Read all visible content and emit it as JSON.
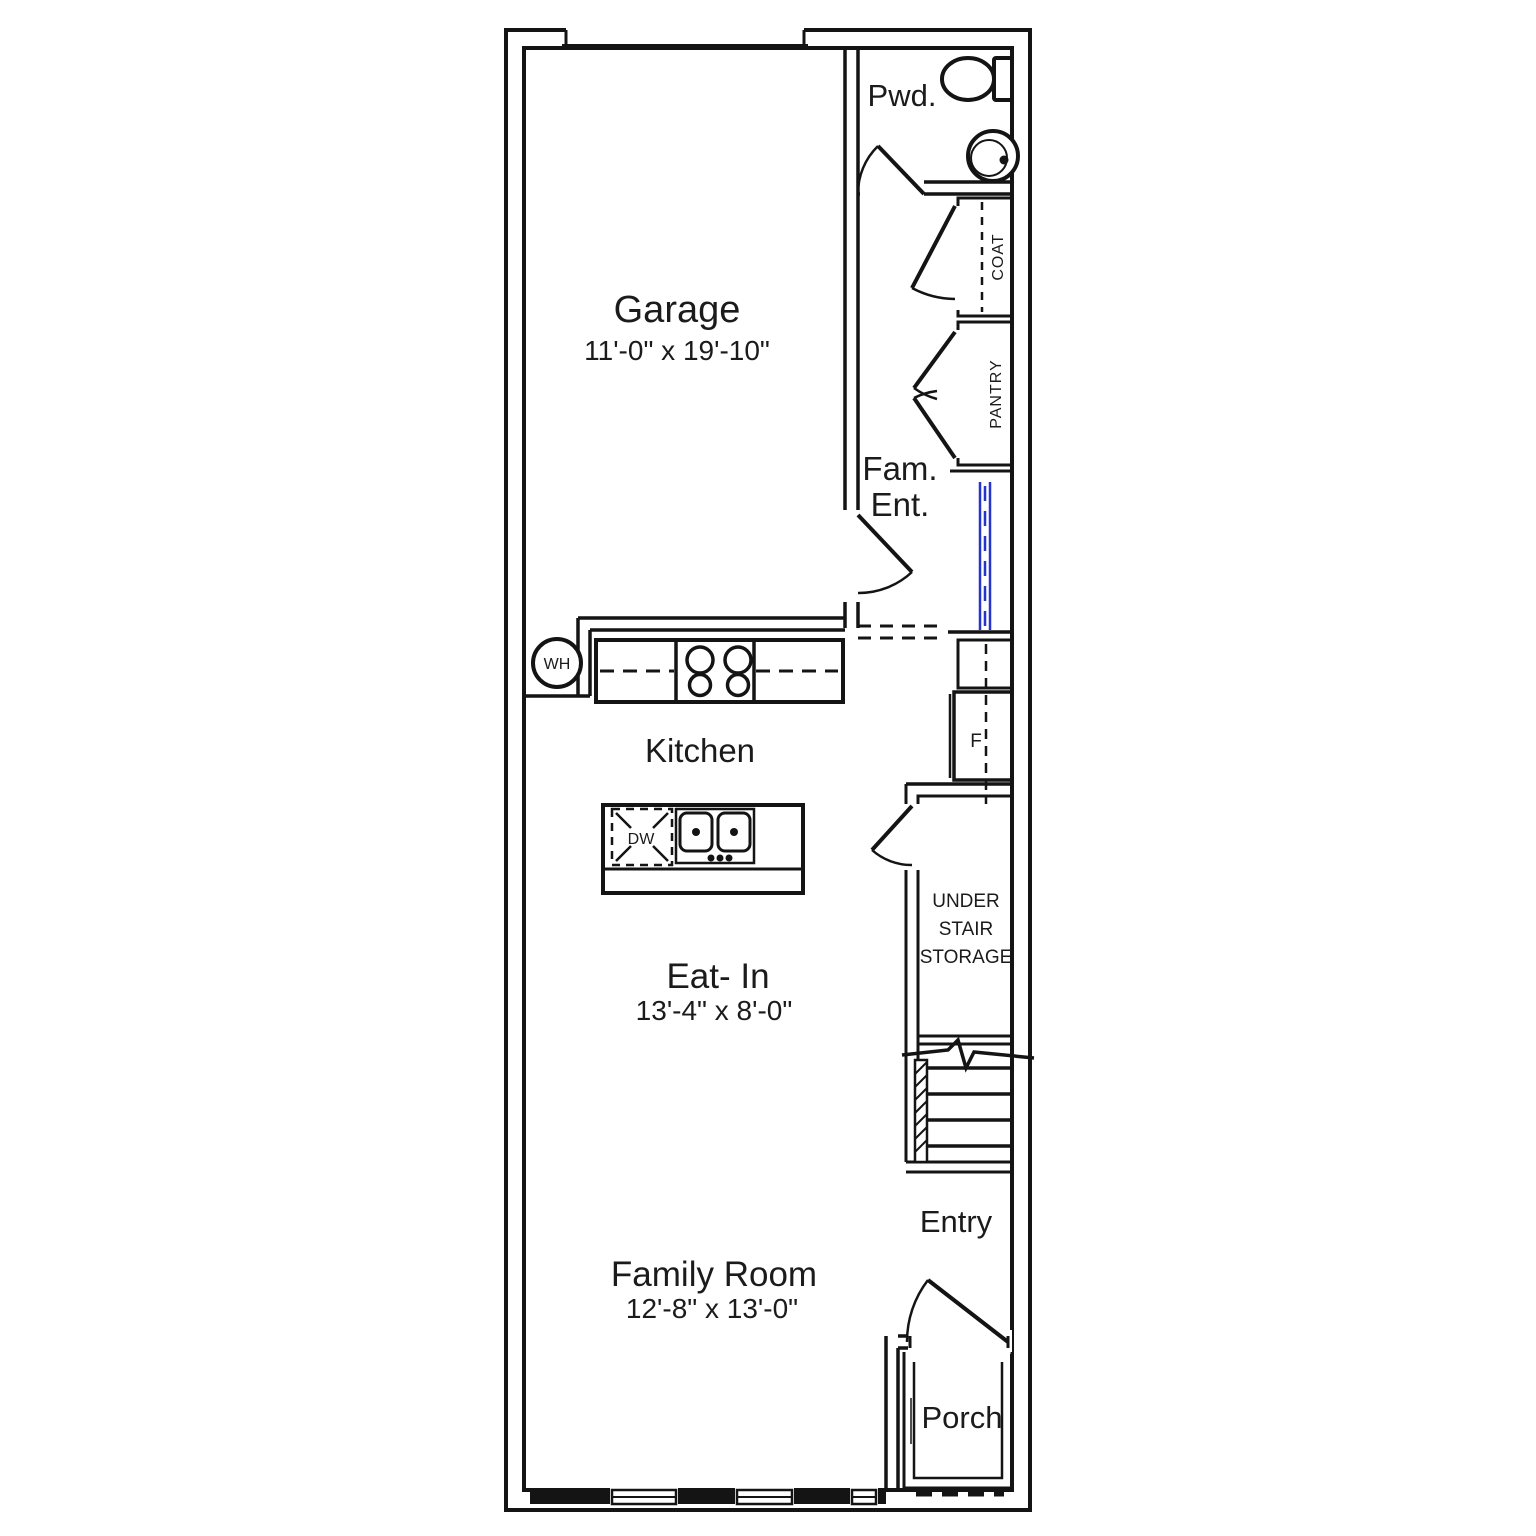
{
  "plan": {
    "title": "First floor townhome floor plan",
    "rooms": {
      "garage": {
        "label": "Garage",
        "dims": "11'-0\" x 19'-10\""
      },
      "powder": {
        "label": "Pwd."
      },
      "family_entry": {
        "line1": "Fam.",
        "line2": "Ent."
      },
      "coat": {
        "label": "COAT"
      },
      "pantry": {
        "label": "PANTRY"
      },
      "kitchen": {
        "label": "Kitchen"
      },
      "eat_in": {
        "label": "Eat- In",
        "dims": "13'-4\" x 8'-0\""
      },
      "under_stair": {
        "line1": "UNDER",
        "line2": "STAIR",
        "line3": "STORAGE"
      },
      "entry": {
        "label": "Entry"
      },
      "family_room": {
        "label": "Family Room",
        "dims": "12'-8\" x 13'-0\""
      },
      "porch": {
        "label": "Porch"
      }
    },
    "fixtures": {
      "water_heater": "WH",
      "dishwasher": "DW",
      "refrigerator": "F"
    },
    "colors": {
      "wall": "#141414",
      "text": "#1b1b1b",
      "accent_blue": "#2535cc",
      "background": "#ffffff"
    }
  }
}
